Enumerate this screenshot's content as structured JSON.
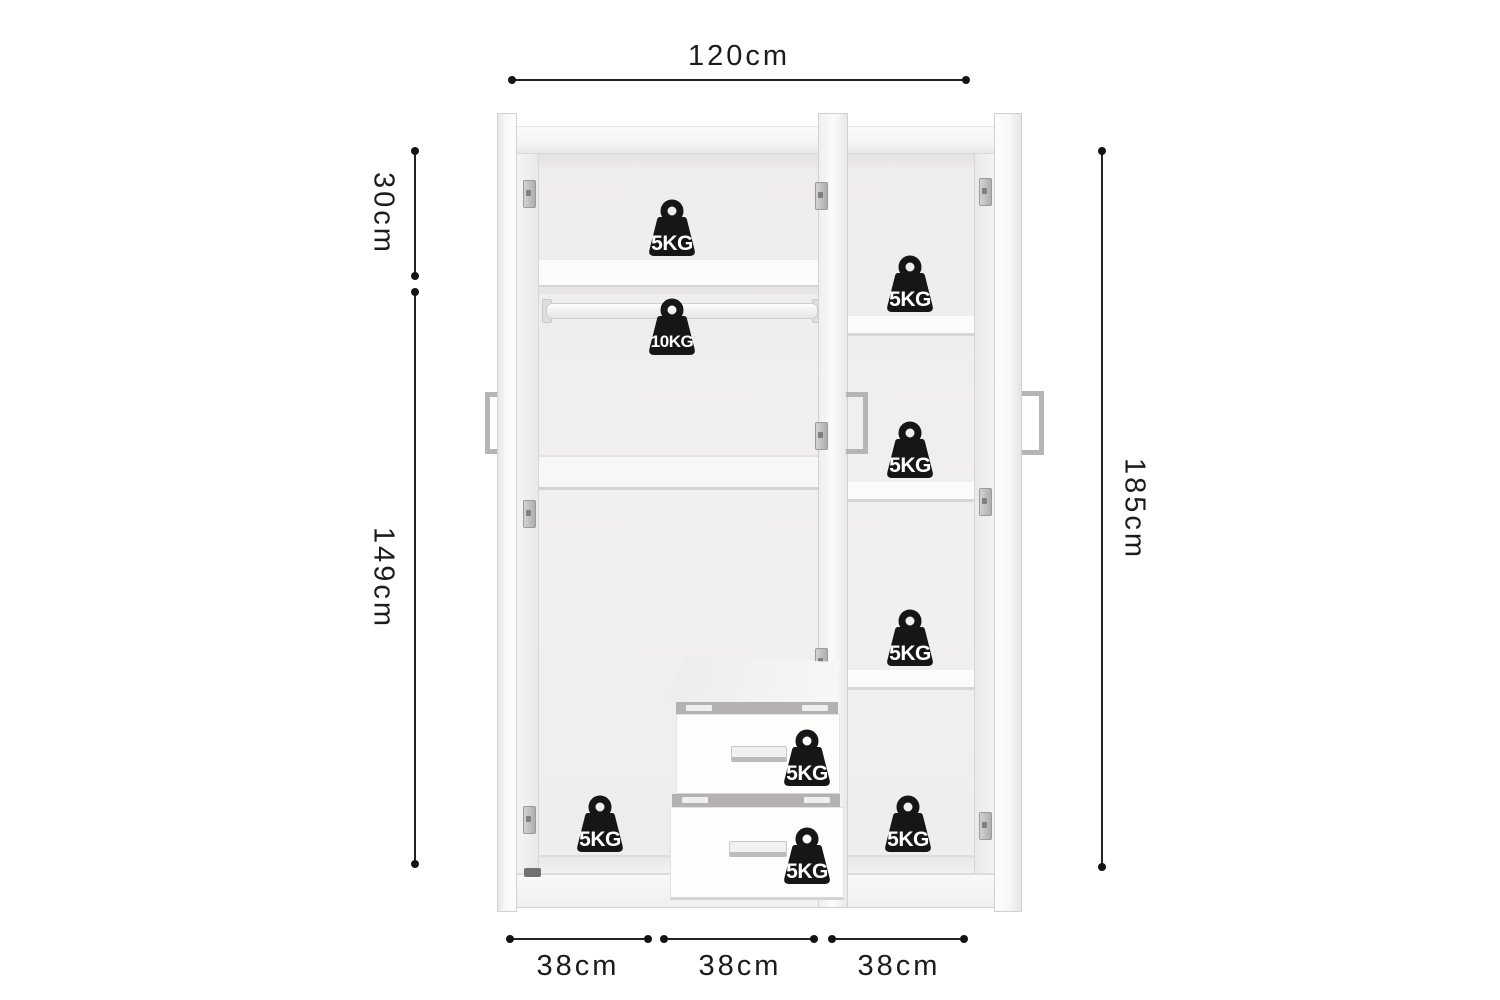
{
  "diagram": {
    "subject": "three-door wardrobe interior dimension diagram",
    "dimensions": {
      "width": "120cm",
      "upper_section_height": "30cm",
      "lower_section_height": "149cm",
      "total_height": "185cm",
      "section_widths": [
        "38cm",
        "38cm",
        "38cm"
      ]
    },
    "capacities": {
      "left_top_shelf": "5KG",
      "hanging_rail": "10KG",
      "right_shelf_1": "5KG",
      "right_shelf_2": "5KG",
      "right_shelf_3": "5KG",
      "drawer_top": "5KG",
      "drawer_bottom": "5KG",
      "left_floor": "5KG",
      "right_floor": "5KG"
    },
    "colors": {
      "background": "#ffffff",
      "dimension_line": "#222220",
      "dimension_text": "#1c1c1c",
      "weight_icon": "#161616",
      "weight_text": "#ffffff",
      "furniture_light": "#fbfbf9",
      "furniture_shadow": "#d7d6d4"
    }
  }
}
